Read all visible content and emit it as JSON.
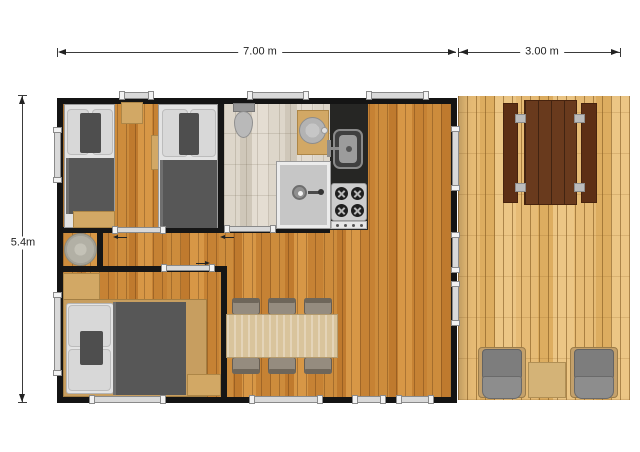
{
  "dimensions": {
    "building_width": "7.00 m",
    "terrace_width": "3.00 m",
    "building_depth": "5.4m"
  },
  "legend": {
    "rooms": [
      "twin-bedroom",
      "bathroom",
      "kitchen",
      "hallway",
      "master-bedroom",
      "living-dining-room",
      "terrace-deck"
    ],
    "furniture": {
      "twin_bedroom": [
        "single-bed",
        "single-bed",
        "nightstand",
        "storage-bench",
        "wall-shelf"
      ],
      "bathroom": [
        "toilet",
        "washbasin-on-stand",
        "shower"
      ],
      "kitchen": [
        "counter",
        "sink",
        "four-burner-stove"
      ],
      "hallway": [
        "round-side-table"
      ],
      "master_bedroom": [
        "double-bed",
        "wardrobe",
        "nightstand"
      ],
      "living_dining_room": [
        "dining-table",
        "dining-chair",
        "dining-chair",
        "dining-chair",
        "dining-chair",
        "dining-chair",
        "dining-chair"
      ],
      "terrace_deck": [
        "picnic-table",
        "picnic-bench",
        "picnic-bench",
        "armchair",
        "armchair",
        "side-table"
      ]
    }
  },
  "colors": {
    "wall": "#141414",
    "interior_wood_floor": "#c9873b",
    "bathroom_floor": "#d9d3c7",
    "deck_wood": "#e3b872",
    "kitchen_counter": "#262624",
    "picnic_table_wood": "#5e3016",
    "armchair_gray": "#828282",
    "window_frame": "#d9d9d9",
    "dimension_line": "#3a3a3a"
  }
}
